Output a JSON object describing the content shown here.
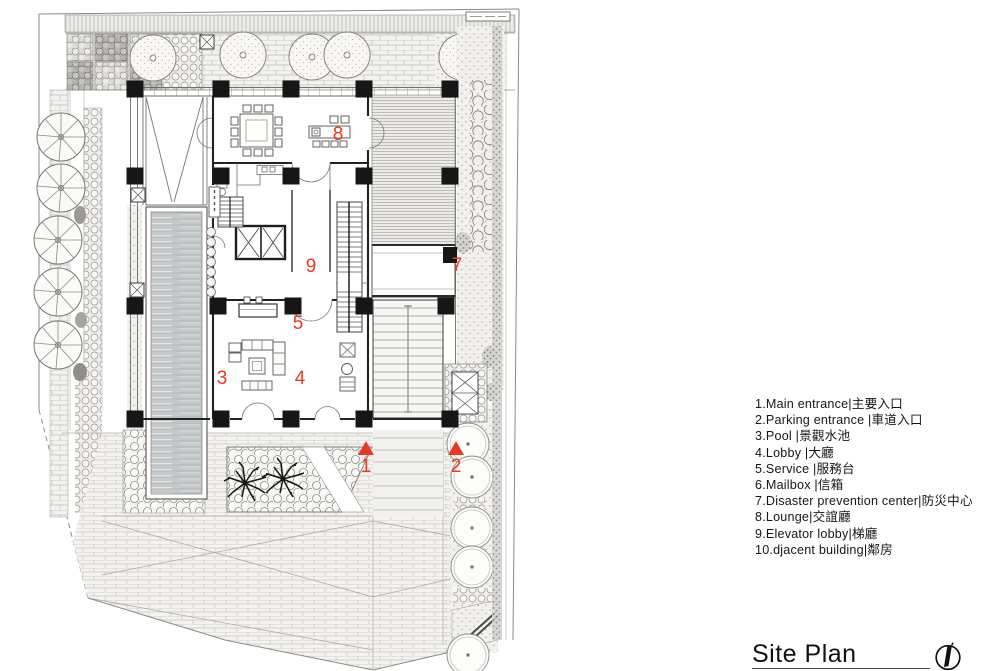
{
  "title": {
    "text": "Site Plan"
  },
  "legend": {
    "items": [
      {
        "label": "1.Main entrance|主要入口"
      },
      {
        "label": "2.Parking  entrance  |車道入口"
      },
      {
        "label": "3.Pool  |景觀水池"
      },
      {
        "label": "4.Lobby  |大廳"
      },
      {
        "label": "5.Service  |服務台"
      },
      {
        "label": "6.Mailbox  |信箱"
      },
      {
        "label": "7.Disaster prevention center|防災中心"
      },
      {
        "label": "8.Lounge|交誼廳"
      },
      {
        "label": "9.Elevator lobby|梯廳"
      },
      {
        "label": "10.djacent building|鄰房"
      }
    ]
  },
  "plan": {
    "colors": {
      "red": "#e73a23",
      "ink": "#161616"
    },
    "labels": [
      {
        "text": "1"
      },
      {
        "text": "2"
      },
      {
        "text": "3"
      },
      {
        "text": "4"
      },
      {
        "text": "5"
      },
      {
        "text": "7"
      },
      {
        "text": "8"
      },
      {
        "text": "9"
      }
    ]
  }
}
